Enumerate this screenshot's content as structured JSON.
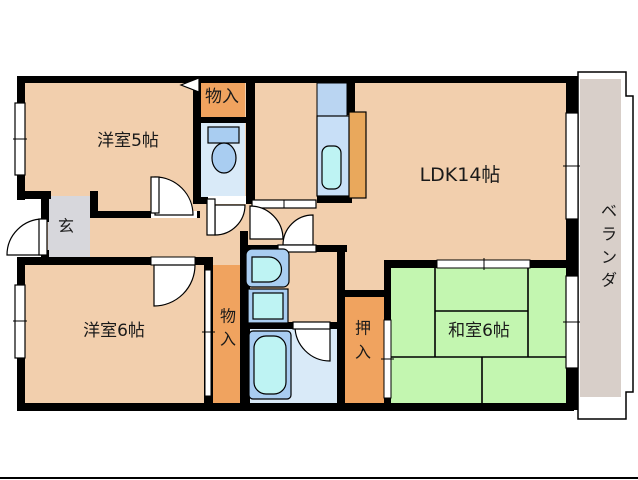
{
  "title": "floor-plan",
  "colors": {
    "wall": "#000000",
    "floor_peach": "#F2CFAD",
    "closet_orange": "#F0A35F",
    "kitchen_orange": "#E9A85C",
    "tatami_green": "#C3F6B0",
    "entry_gray": "#D7D7DC",
    "veranda_gray": "#D8CFC9",
    "wet_room_blue": "#D9EAF8",
    "fixture_blue": "#A9CDF1",
    "fixture_cyan": "#BEF3F3",
    "kitchen_blue_upper": "#BAD5F2",
    "kitchen_blue_counter": "#C8DFF7",
    "outline_white": "#FFFFFF",
    "text": "#1A1A1A"
  },
  "labels": {
    "western5": "洋室5帖",
    "western6": "洋室6帖",
    "ldk": "LDK14帖",
    "japanese": "和室6帖",
    "entry": "玄",
    "storage_top": "物入",
    "storage_bottom": [
      "物",
      "入"
    ],
    "oshiire": [
      "押",
      "入"
    ],
    "veranda": [
      "ベ",
      "ラ",
      "ン",
      "ダ"
    ]
  }
}
